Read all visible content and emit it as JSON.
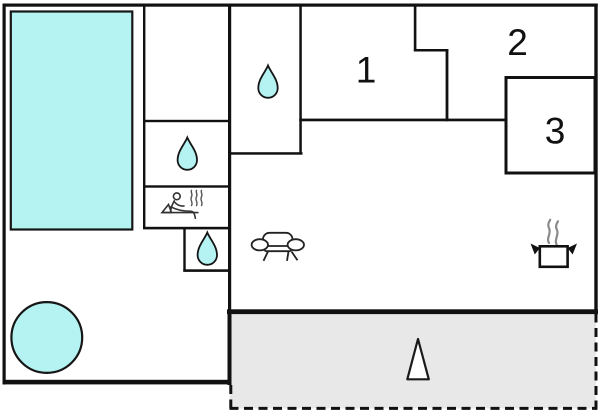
{
  "meta": {
    "type": "floor-plan"
  },
  "colors": {
    "wall": "#111111",
    "water": "#b5f2f2",
    "terrace": "#e8e8e8",
    "background": "#ffffff",
    "icon_stroke": "#222222",
    "steam": "#8a8a8a",
    "label": "#111111"
  },
  "rooms": {
    "room1": {
      "label": "1"
    },
    "room2": {
      "label": "2"
    },
    "room3": {
      "label": "3"
    }
  },
  "icons": {
    "pool": "swimming-pool",
    "hot_tub": "hot-tub-circle",
    "drop": "water-drop-icon",
    "sauna": "sauna-person-icon",
    "sofa": "sofa-icon",
    "pot": "cooking-pot-icon",
    "cone": "tree-cone-icon",
    "terrace": "terrace-area"
  }
}
